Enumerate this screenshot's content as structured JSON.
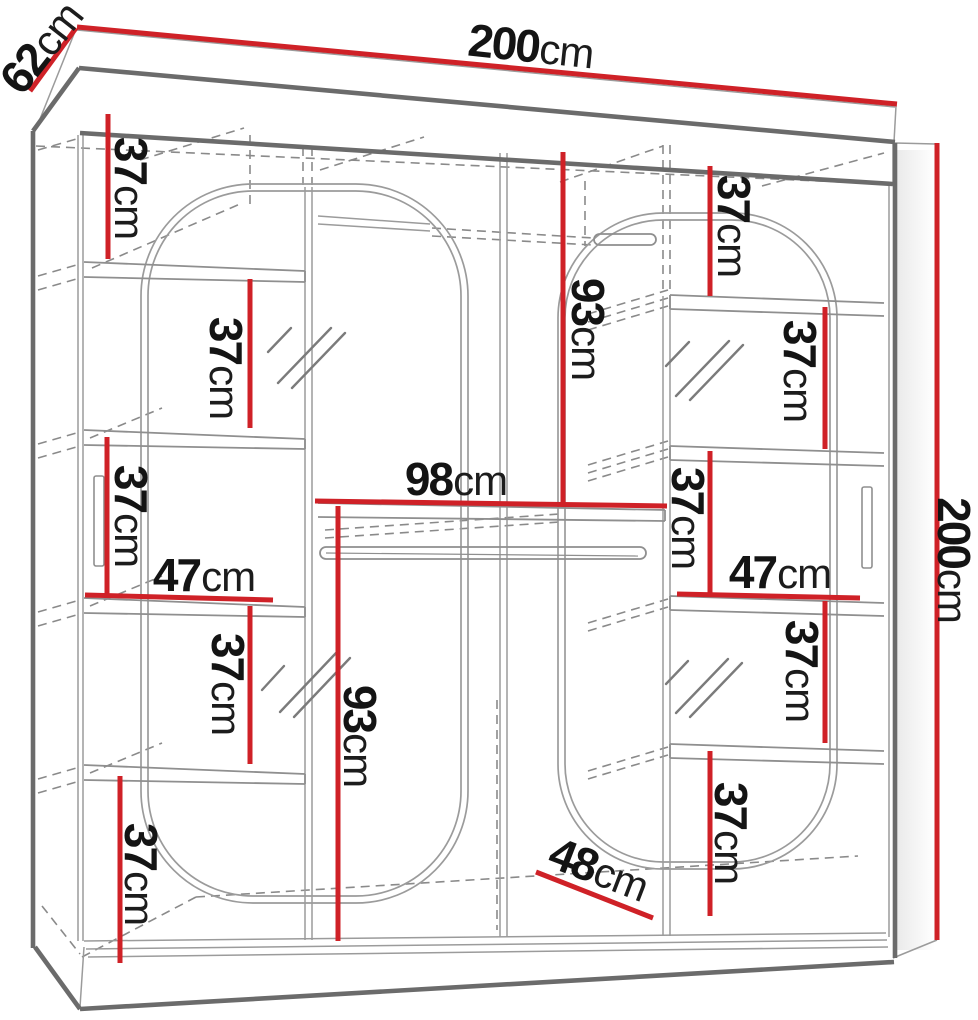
{
  "diagram": {
    "subject": "wardrobe-dimension-drawing",
    "colors": {
      "dimension_red": "#cf2127",
      "outline_dark_gray": "#6b6b6b",
      "line_gray": "#8f8f8f",
      "text": "#141414"
    },
    "labels": {
      "width_top": {
        "num": "200",
        "unit": "cm"
      },
      "depth_top": {
        "num": "62",
        "unit": "cm"
      },
      "height_right": {
        "num": "200",
        "unit": "cm"
      },
      "shelf_gap_left_1": {
        "num": "37",
        "unit": "cm"
      },
      "shelf_gap_left_2": {
        "num": "37",
        "unit": "cm"
      },
      "shelf_gap_left_3": {
        "num": "37",
        "unit": "cm"
      },
      "shelf_gap_left_4": {
        "num": "37",
        "unit": "cm"
      },
      "shelf_gap_left_5": {
        "num": "37",
        "unit": "cm"
      },
      "shelf_width_left": {
        "num": "47",
        "unit": "cm"
      },
      "hang_height_left": {
        "num": "93",
        "unit": "cm"
      },
      "hang_height_right": {
        "num": "93",
        "unit": "cm"
      },
      "mid_shelf_width": {
        "num": "98",
        "unit": "cm"
      },
      "shelf_gap_right_1": {
        "num": "37",
        "unit": "cm"
      },
      "shelf_gap_right_2": {
        "num": "37",
        "unit": "cm"
      },
      "shelf_gap_right_3": {
        "num": "37",
        "unit": "cm"
      },
      "shelf_gap_right_4": {
        "num": "37",
        "unit": "cm"
      },
      "shelf_gap_right_5": {
        "num": "37",
        "unit": "cm"
      },
      "shelf_width_right": {
        "num": "47",
        "unit": "cm"
      },
      "bottom_depth": {
        "num": "48",
        "unit": "cm"
      }
    }
  }
}
